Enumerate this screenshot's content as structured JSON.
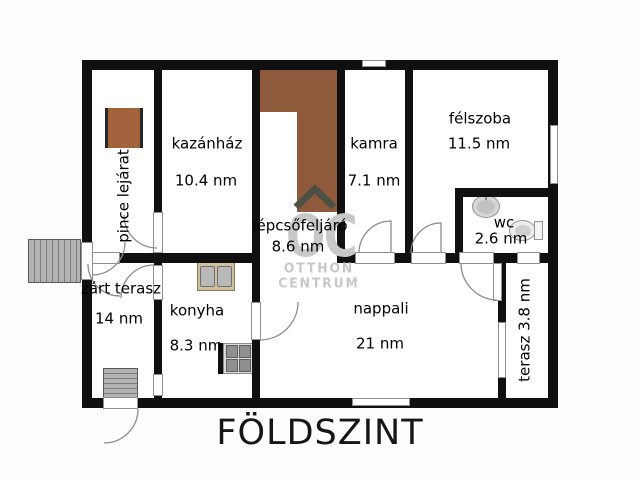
{
  "title": "FÖLDSZINT",
  "watermark": {
    "logo": "OC",
    "line1": "OTTHON",
    "line2": "CENTRUM"
  },
  "rooms": {
    "pince_lejarat": {
      "name": "pince lejárat"
    },
    "kazanhaz": {
      "name": "kazánház",
      "area": "10.4 nm"
    },
    "lepcsofeljaro": {
      "name": "lépcsőfeljáró",
      "area": "8.6 nm"
    },
    "kamra": {
      "name": "kamra",
      "area": "7.1 nm"
    },
    "felszoba": {
      "name": "félszoba",
      "area": "11.5 nm"
    },
    "wc": {
      "name": "wc",
      "area": "2.6 nm"
    },
    "zart_terasz": {
      "name": "zárt terasz",
      "area": "14 nm"
    },
    "konyha": {
      "name": "konyha",
      "area": "8.3 nm"
    },
    "nappali": {
      "name": "nappali",
      "area": "21 nm"
    },
    "terasz": {
      "name": "terasz 3.8 nm"
    }
  },
  "colors": {
    "wall": "#101010",
    "stair-brown": "#8e5a3b",
    "pince-brown": "#a2633c",
    "watermark-gray": "#c8c8c8",
    "door-line": "#8c8c8c",
    "chevron": "#4d5145"
  }
}
